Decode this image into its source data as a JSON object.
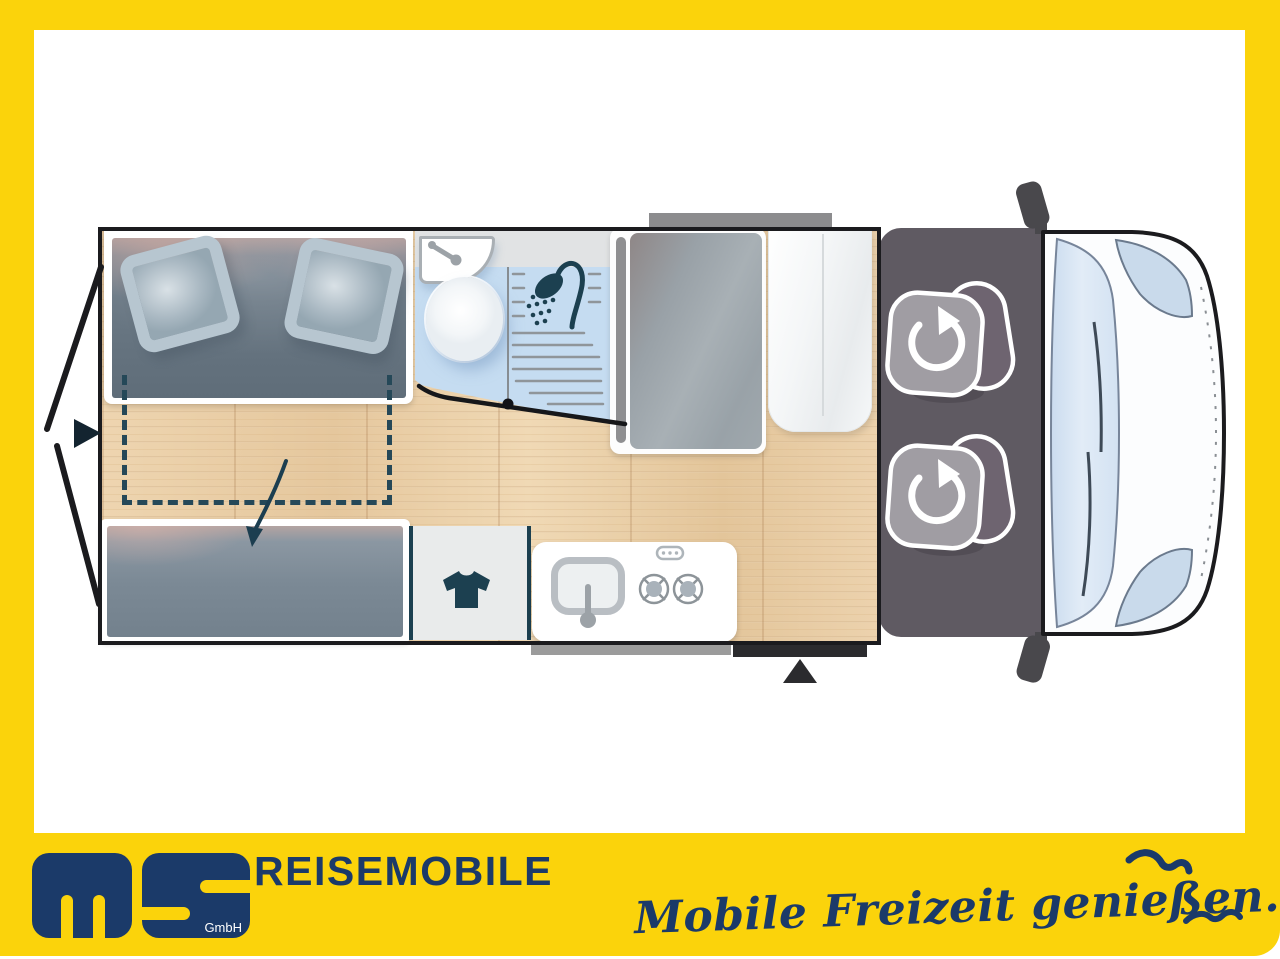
{
  "frame": {
    "border_color": "#FBD30B"
  },
  "floorplan": {
    "type": "camper-van top-view layout",
    "features": [
      "rear-double-bed-with-two-pillows",
      "fold-down-bed-extension-dashed-outline",
      "lower-bed-bench",
      "bathroom-with-washbasin-toilet-shower",
      "wardrobe-unit",
      "tall-cabinet",
      "clothes-closet-t-shirt-icon",
      "kitchen-with-sink-and-two-burner-stove",
      "driver-cab-with-two-swivel-seats",
      "entry-door-triangle-marker",
      "open-rear-doors-with-arrow"
    ],
    "colors": {
      "wood_floor": "#EBD1AC",
      "bathroom_blue": "#C5DCF1",
      "cushion_grey": "#6B7985",
      "cab_grey": "#5F5A62",
      "icon_teal": "#1C4050",
      "wall_black": "#1B1B1E"
    }
  },
  "footer": {
    "logo": {
      "monogram": "ms",
      "sub_label": "GmbH"
    },
    "wordmark": "REISEMOBILE",
    "tagline": "Mobile Freizeit genießen.",
    "colors": {
      "navy": "#1B3A69",
      "yellow": "#FBD30B"
    },
    "icons": [
      "seagull-icon",
      "seagull-icon"
    ]
  }
}
